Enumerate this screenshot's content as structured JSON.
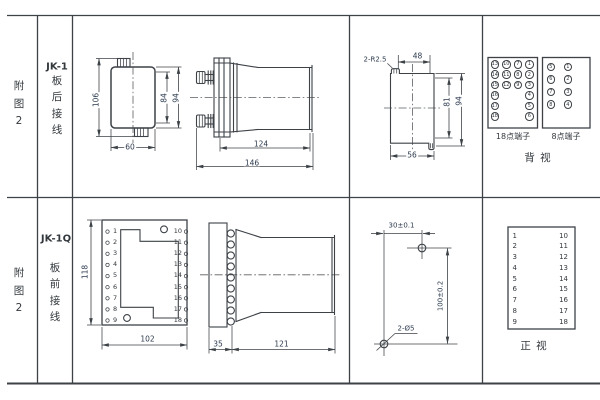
{
  "colors": {
    "line": "#3d4247",
    "text": "#33383d",
    "dimc": "#2c3a4e"
  },
  "fig_top": {
    "label_chars": [
      "附",
      "图",
      "2"
    ]
  },
  "fig_bottom": {
    "label_chars": [
      "附",
      "图",
      "2"
    ]
  },
  "top": {
    "model": "JK-1",
    "wiring_chars": [
      "板",
      "后",
      "接",
      "线"
    ],
    "dims": {
      "front_h": "106",
      "front_w": "60",
      "front_inner": "84",
      "front_outer": "94",
      "side_body": "124",
      "side_overall": "146"
    },
    "cutout": {
      "corner_label": "2-R2.5",
      "top": "48",
      "inner_h": "81",
      "outer_h": "94",
      "width": "56"
    },
    "terminal18": {
      "label": "18点端子",
      "cells": [
        "13",
        "10",
        "7",
        "1",
        "14",
        "11",
        "8",
        "2",
        "15",
        "12",
        "9",
        "3",
        "16",
        "",
        "",
        "4",
        "17",
        "",
        "",
        "5",
        "18",
        "",
        "",
        "6"
      ]
    },
    "terminal8": {
      "label": "8点端子",
      "cells": [
        "5",
        "1",
        "6",
        "2",
        "7",
        "3",
        "8",
        "4"
      ]
    },
    "view_label": "背  视"
  },
  "bottom": {
    "model": "JK-1Q",
    "wiring_chars": [
      "板",
      "前",
      "接",
      "线"
    ],
    "front": {
      "left_numbers": [
        "1",
        "2",
        "3",
        "4",
        "5",
        "6",
        "7",
        "8",
        "9"
      ],
      "right_numbers": [
        "10",
        "11",
        "12",
        "13",
        "14",
        "15",
        "16",
        "17",
        "18"
      ],
      "height": "118",
      "width": "102"
    },
    "side": {
      "front_depth": "35",
      "body_depth": "121"
    },
    "drill": {
      "horizontal": "30±0.1",
      "vertical": "100±0.2",
      "holes": "2-Ø5"
    },
    "table": {
      "left": [
        "1",
        "2",
        "3",
        "4",
        "5",
        "6",
        "7",
        "8",
        "9"
      ],
      "right": [
        "10",
        "11",
        "12",
        "13",
        "14",
        "15",
        "16",
        "17",
        "18"
      ],
      "view_label": "正  视"
    }
  }
}
